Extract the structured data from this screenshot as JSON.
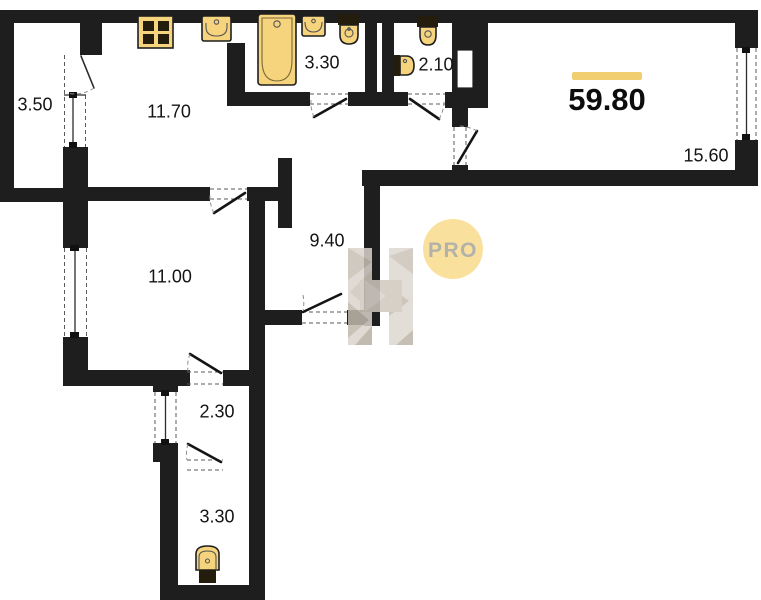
{
  "plan": {
    "total_area": "59.80",
    "watermark_text": "PRO",
    "rooms": {
      "balcony": "3.50",
      "kitchen": "11.70",
      "bathroom": "3.30",
      "wc": "2.10",
      "living_room": "15.60",
      "hallway": "9.40",
      "bedroom": "11.00",
      "corridor": "2.30",
      "storage": "3.30"
    },
    "colors": {
      "wall": "#1E1E1E",
      "fixture": "#F6D37D",
      "accent_bar": "#F1CE6F",
      "watermark_circle": "#F8DC8D",
      "watermark_letters": "#A5A49C"
    }
  }
}
